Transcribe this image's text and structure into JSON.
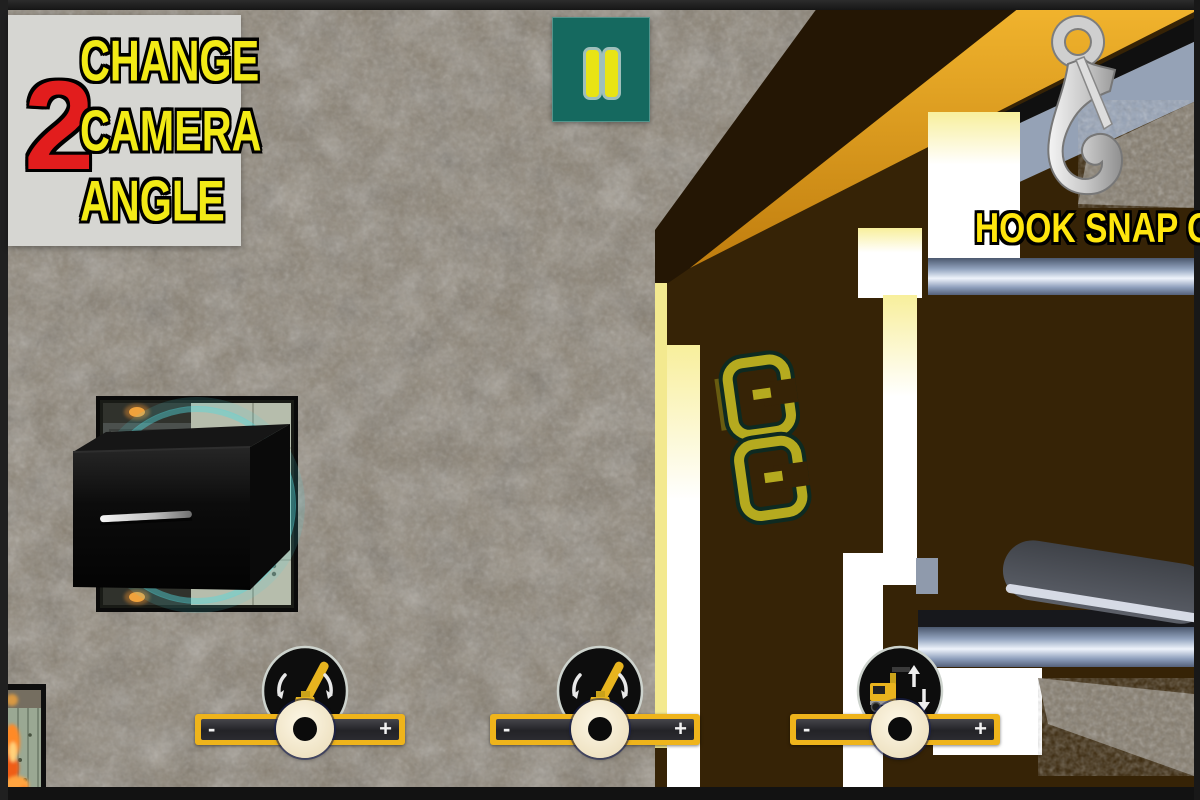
{
  "hud": {
    "camera_button": {
      "number": "2",
      "lines": [
        "CHANGE",
        "CAMERA",
        "ANGLE"
      ]
    },
    "pause": {
      "icon": "pause-icon"
    },
    "hook_status": {
      "label": "HOOK SNAP ON",
      "icon": "crane-hook-icon"
    }
  },
  "sliders": [
    {
      "name": "crane-boom-control-1",
      "icon": "crane-rotate-icon",
      "minus_label": "-",
      "plus_label": "+"
    },
    {
      "name": "crane-boom-control-2",
      "icon": "crane-rotate-icon",
      "minus_label": "-",
      "plus_label": "+"
    },
    {
      "name": "truck-lift-control",
      "icon": "truck-lift-icon",
      "minus_label": "-",
      "plus_label": "+"
    }
  ],
  "scene": {
    "objects": [
      "ground-rock-texture",
      "loading-platform",
      "cargo-crate",
      "furnace-container",
      "crane-truck-top-view"
    ]
  },
  "colors": {
    "hud_panel_gray": "#d6d6d2",
    "alert_red": "#e21d1d",
    "accent_yellow": "#f2ea16",
    "pause_teal": "#15695f",
    "slider_yellow": "#efb41b",
    "boom_orange": "#e09a1d",
    "truck_brown": "#362306",
    "hook_text_yellow": "#ffe60e",
    "glow_teal": "#52dade"
  }
}
